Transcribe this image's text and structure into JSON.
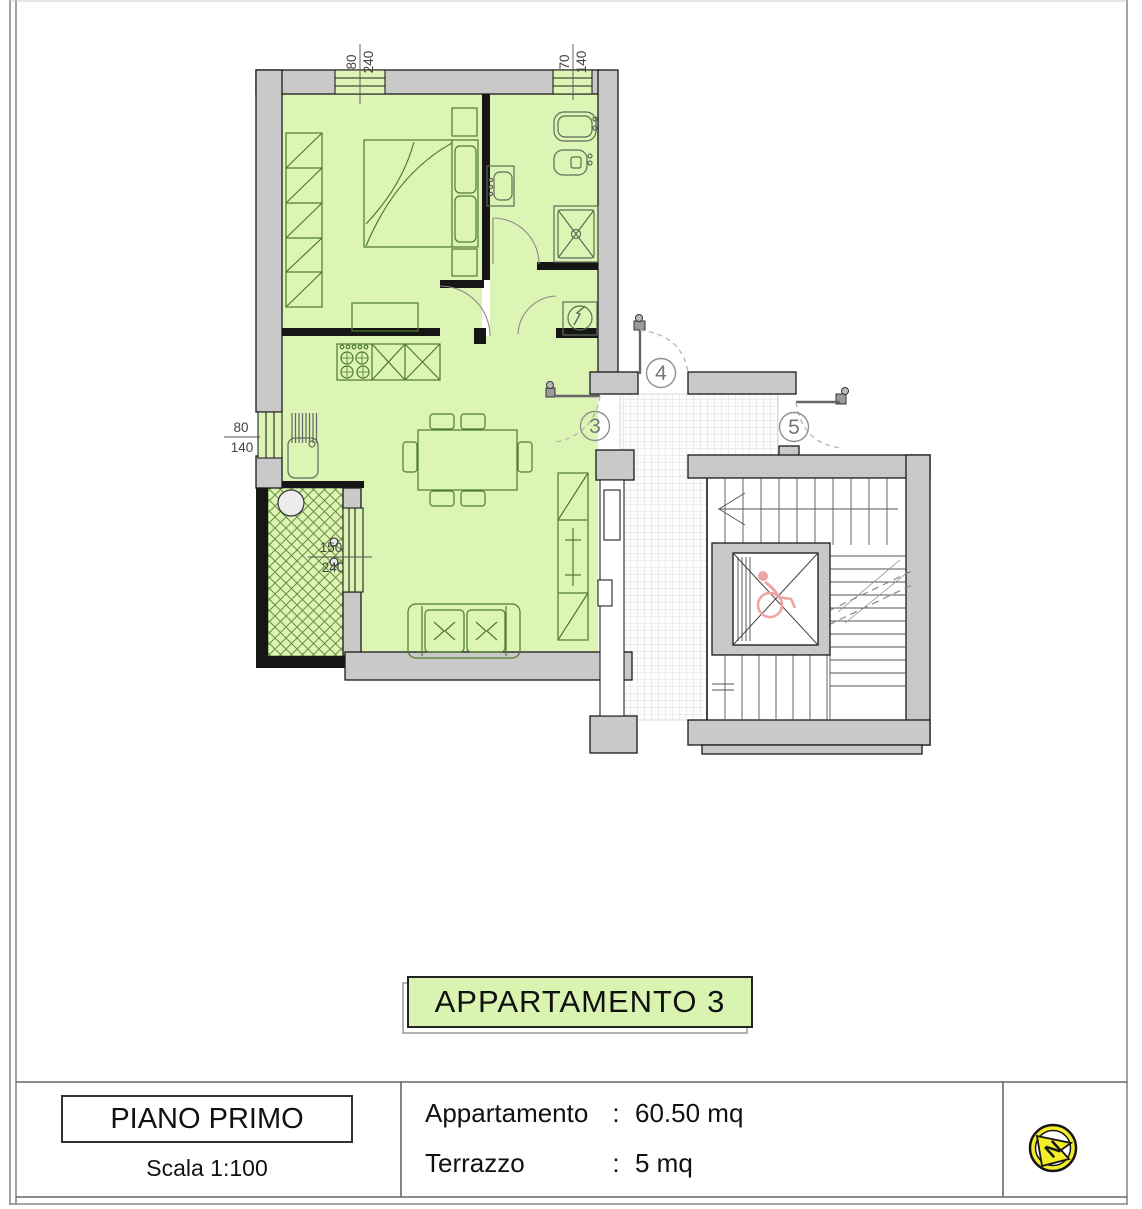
{
  "plan": {
    "dimensions": {
      "bedroom_window": {
        "w": "80",
        "h": "240"
      },
      "bathroom_window": {
        "w": "70",
        "h": "140"
      },
      "kitchen_window": {
        "w": "80",
        "h": "140"
      },
      "terrace_door": {
        "w": "150",
        "h": "240"
      }
    },
    "door_markers": {
      "three": "3",
      "four": "4",
      "five": "5"
    }
  },
  "title_box": {
    "label": "APPARTAMENTO 3"
  },
  "title_block": {
    "floor_label": "PIANO PRIMO",
    "scale_label": "Scala 1:100",
    "rows": [
      {
        "label": "Appartamento",
        "colon": ":",
        "value": "60.50 mq"
      },
      {
        "label": "Terrazzo",
        "colon": ":",
        "value": "5 mq"
      }
    ],
    "north_letter": "N"
  },
  "colors": {
    "apartment_fill": "#dcf4b4",
    "title_box_fill": "#d9f4b0",
    "wall_fill": "#c9c9c9",
    "terrace_hatch_stroke": "#6b8f3f",
    "wheelchair_pink": "#f0a3a3",
    "north_yellow": "#f2ee2a"
  }
}
